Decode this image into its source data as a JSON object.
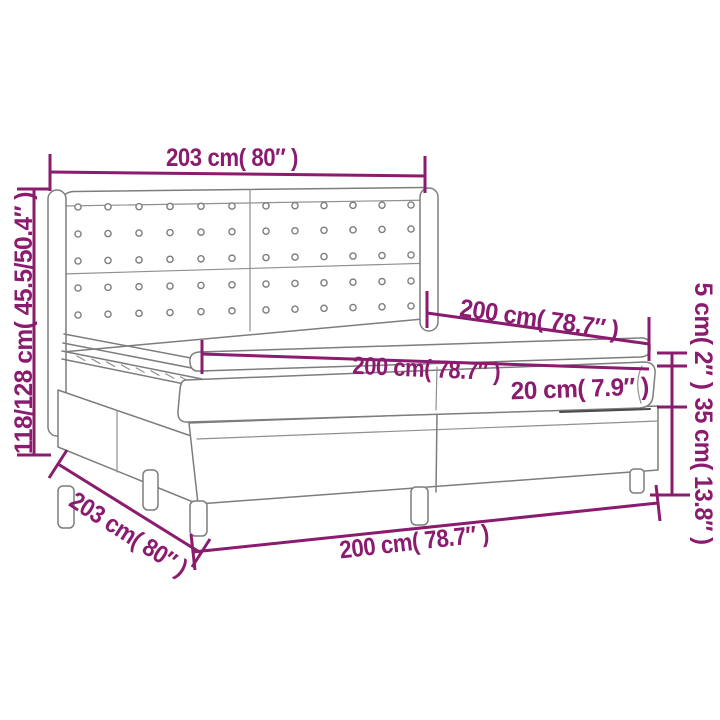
{
  "diagram": {
    "name": "box-spring-bed-dimension-diagram",
    "labels": {
      "headboard_width": "203 cm( 80″ )",
      "total_height": "118/128 cm( 45.5/50.4″ )",
      "bed_depth": "200 cm( 78.7″ )",
      "mattress_width": "200 cm( 78.7″ )",
      "mattress_height": "20 cm( 7.9″ )",
      "topper_height": "5 cm( 2″ )",
      "base_height": "35 cm( 13.8″ )",
      "base_width_side": "203 cm( 80″ )",
      "base_width_front": "200 cm( 78.7″ )"
    },
    "colors": {
      "dimension": "#8a1b6e",
      "lineart": "#7d7d7d",
      "background": "#ffffff"
    }
  }
}
